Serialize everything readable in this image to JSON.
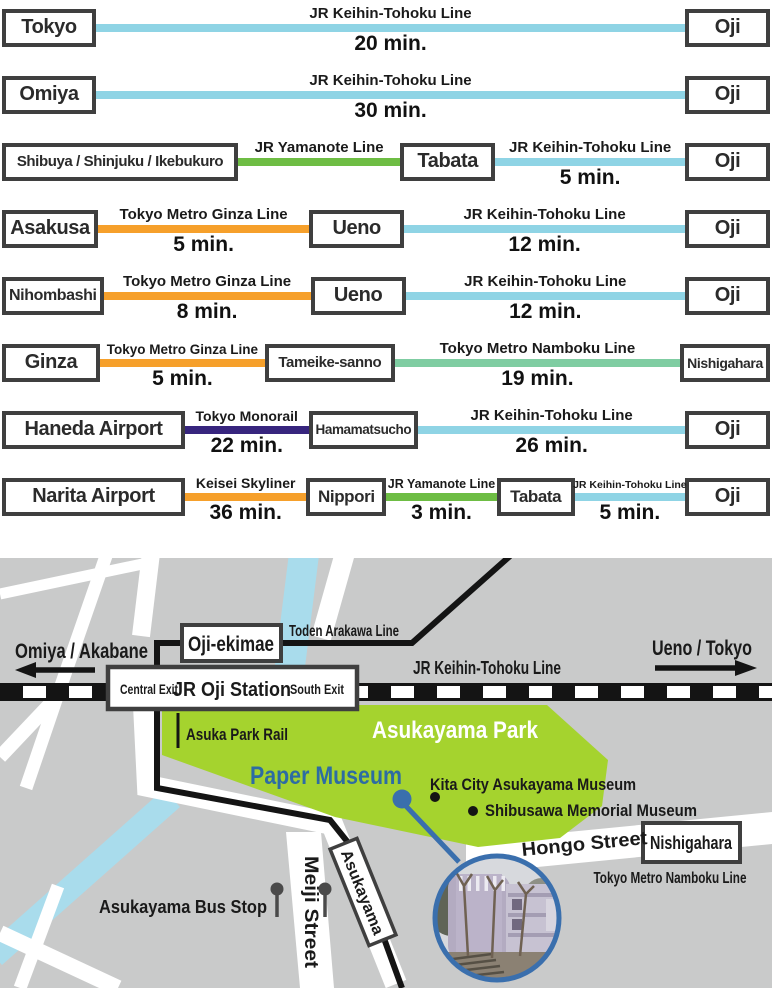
{
  "palette": {
    "keihin": "#8fd4e5",
    "yamanote": "#6ebd44",
    "ginza": "#f6a02b",
    "skyliner": "#f6a02b",
    "namboku": "#7fcda2",
    "monorail": "#37257e",
    "ink": "#141414",
    "box_border": "#3f3f3f",
    "bg_gray": "#c9caca",
    "river": "#a9dcec",
    "park": "#a5d32e",
    "museum_blue": "#2d6ca3",
    "ring_blue": "#3a6fad",
    "road_white": "#ffffff"
  },
  "routes": {
    "rows": [
      {
        "items": [
          {
            "type": "station",
            "label": "Tokyo",
            "w": 94
          },
          {
            "type": "segment",
            "line": "JR Keihin-Tohoku Line",
            "time": "20 min.",
            "color": "keihin",
            "grow": 1
          },
          {
            "type": "station",
            "label": "Oji",
            "w": 85
          }
        ]
      },
      {
        "items": [
          {
            "type": "station",
            "label": "Omiya",
            "w": 94
          },
          {
            "type": "segment",
            "line": "JR Keihin-Tohoku Line",
            "time": "30 min.",
            "color": "keihin",
            "grow": 1
          },
          {
            "type": "station",
            "label": "Oji",
            "w": 85
          }
        ]
      },
      {
        "items": [
          {
            "type": "station",
            "label": "Shibuya / Shinjuku / Ikebukuro",
            "w": 236,
            "fs": 15
          },
          {
            "type": "segment",
            "line": "JR Yamanote Line",
            "time": "",
            "color": "yamanote",
            "grow": 1
          },
          {
            "type": "station",
            "label": "Tabata",
            "w": 95
          },
          {
            "type": "segment",
            "line": "JR Keihin-Tohoku Line",
            "time": "5 min.",
            "color": "keihin",
            "grow": 1.17
          },
          {
            "type": "station",
            "label": "Oji",
            "w": 85
          }
        ]
      },
      {
        "items": [
          {
            "type": "station",
            "label": "Asakusa",
            "w": 96
          },
          {
            "type": "segment",
            "line": "Tokyo Metro Ginza Line",
            "time": "5 min.",
            "color": "ginza",
            "grow": 1
          },
          {
            "type": "station",
            "label": "Ueno",
            "w": 95
          },
          {
            "type": "segment",
            "line": "JR Keihin-Tohoku Line",
            "time": "12 min.",
            "color": "keihin",
            "grow": 1.33
          },
          {
            "type": "station",
            "label": "Oji",
            "w": 85
          }
        ]
      },
      {
        "items": [
          {
            "type": "station",
            "label": "Nihombashi",
            "w": 100,
            "fs": 16
          },
          {
            "type": "segment",
            "line": "Tokyo Metro Ginza Line",
            "time": "8 min.",
            "color": "ginza",
            "grow": 1
          },
          {
            "type": "station",
            "label": "Ueno",
            "w": 95
          },
          {
            "type": "segment",
            "line": "JR Keihin-Tohoku Line",
            "time": "12 min.",
            "color": "keihin",
            "grow": 1.35
          },
          {
            "type": "station",
            "label": "Oji",
            "w": 85
          }
        ]
      },
      {
        "items": [
          {
            "type": "station",
            "label": "Ginza",
            "w": 98
          },
          {
            "type": "segment",
            "line": "Tokyo Metro Ginza Line",
            "time": "5 min.",
            "color": "ginza",
            "grow": 1,
            "lfs": 13.5
          },
          {
            "type": "station",
            "label": "Tameike-sanno",
            "w": 130,
            "fs": 15
          },
          {
            "type": "segment",
            "line": "Tokyo Metro Namboku Line",
            "time": "19 min.",
            "color": "namboku",
            "grow": 1.73
          },
          {
            "type": "station",
            "label": "Nishigahara",
            "w": 90,
            "fs": 14
          }
        ]
      },
      {
        "items": [
          {
            "type": "station",
            "label": "Haneda Airport",
            "w": 183,
            "fs": 20
          },
          {
            "type": "segment",
            "line": "Tokyo Monorail",
            "time": "22 min.",
            "color": "monorail",
            "grow": 1,
            "lfs": 14
          },
          {
            "type": "station",
            "label": "Hamamatsucho",
            "w": 105,
            "fs": 13.5
          },
          {
            "type": "segment",
            "line": "JR Keihin-Tohoku Line",
            "time": "26 min.",
            "color": "keihin",
            "grow": 2.16
          },
          {
            "type": "station",
            "label": "Oji",
            "w": 85
          }
        ]
      },
      {
        "items": [
          {
            "type": "station",
            "label": "Narita Airport",
            "w": 183,
            "fs": 20
          },
          {
            "type": "segment",
            "line": "Keisei Skyliner",
            "time": "36 min.",
            "color": "skyliner",
            "grow": 1.1,
            "lfs": 14
          },
          {
            "type": "station",
            "label": "Nippori",
            "w": 80,
            "fs": 17
          },
          {
            "type": "segment",
            "line": "JR Yamanote Line",
            "time": "3 min.",
            "color": "yamanote",
            "grow": 1,
            "lfs": 12.5
          },
          {
            "type": "station",
            "label": "Tabata",
            "w": 78,
            "fs": 17
          },
          {
            "type": "segment",
            "line": "JR Keihin-Tohoku Line",
            "time": "5 min.",
            "color": "keihin",
            "grow": 1,
            "lfs": 10.5
          },
          {
            "type": "station",
            "label": "Oji",
            "w": 85
          }
        ]
      }
    ]
  },
  "map": {
    "rivers": [
      {
        "pts": "304,554 288,682",
        "w": 30
      },
      {
        "pts": "172,798 -6,956",
        "w": 24
      }
    ],
    "roads": [
      {
        "pts": "144,705 148,786 332,824 396,984",
        "w": 22
      },
      {
        "pts": "0,594 152,562",
        "w": 11
      },
      {
        "pts": "106,556 57,697 26,788",
        "w": 13
      },
      {
        "pts": "151,553 141,636",
        "w": 18
      },
      {
        "pts": "345,553 321,638",
        "w": 20
      },
      {
        "pts": "52,702 0,757",
        "w": 14
      },
      {
        "pts": "0,933 118,988",
        "w": 16
      },
      {
        "pts": "58,886 20,988",
        "w": 13
      }
    ],
    "road_polys": [
      {
        "points": "286,832 321,832 334,988 300,988",
        "name": "meiji-street-road"
      },
      {
        "points": "466,842 772,812 772,844 466,874",
        "name": "hongo-street-road"
      }
    ],
    "park": {
      "points": "162,705 547,705 608,760 602,806 560,838 478,847 335,817 162,755"
    },
    "tram": {
      "pts": "510,556 412,643 157,643 157,788 330,820 350,845 402,988",
      "w": 6
    },
    "railway": {
      "y": 683,
      "h": 18,
      "dash": 23
    },
    "ticks": [
      {
        "x1": 178,
        "y1": 713,
        "x2": 178,
        "y2": 748,
        "w": 3
      }
    ],
    "arrows": [
      {
        "name": "west-arrow",
        "shaft": "95,670 34,670",
        "head": "36,662 36,678 15,670"
      },
      {
        "name": "east-arrow",
        "shaft": "655,668 737,668",
        "head": "735,660 735,676 757,668"
      }
    ],
    "boxes": [
      {
        "name": "oji-ekimae-box",
        "x": 182,
        "y": 625,
        "w": 99,
        "h": 36,
        "sw": 4
      },
      {
        "name": "jr-oji-station-box",
        "x": 108,
        "y": 667,
        "w": 249,
        "h": 42,
        "sw": 4.5
      },
      {
        "name": "nishigahara-box",
        "x": 643,
        "y": 823,
        "w": 97,
        "h": 39,
        "sw": 4
      },
      {
        "name": "asukayama-tram-stop-box",
        "cx": 363,
        "cy": 892,
        "w": 104,
        "h": 29,
        "sw": 3.5,
        "rotate": 68
      }
    ],
    "labels": [
      {
        "name": "toden-arakawa-line-label",
        "text": "Toden Arakawa Line",
        "x": 344,
        "y": 636,
        "fs": 16,
        "tl": 110
      },
      {
        "name": "omiya-akabane-label",
        "text": "Omiya / Akabane",
        "x": 15,
        "y": 658,
        "fs": 21,
        "tl": 133,
        "anchor": "start"
      },
      {
        "name": "ueno-tokyo-label",
        "text": "Ueno / Tokyo",
        "x": 702,
        "y": 655,
        "fs": 21,
        "tl": 100
      },
      {
        "name": "jr-keihin-tohoku-map-label",
        "text": "JR Keihin-Tohoku Line",
        "x": 487,
        "y": 674,
        "fs": 18,
        "tl": 148
      },
      {
        "name": "asuka-park-rail-label",
        "text": "Asuka Park Rail",
        "x": 186,
        "y": 740,
        "fs": 17,
        "tl": 102,
        "anchor": "start"
      },
      {
        "name": "asukayama-park-label",
        "text": "Asukayama Park",
        "x": 455,
        "y": 738,
        "fs": 24,
        "tl": 166,
        "color": "#ffffff"
      },
      {
        "name": "paper-museum-label",
        "text": "Paper Museum",
        "x": 326,
        "y": 784,
        "fs": 25,
        "tl": 152,
        "color": "#2d6ca3"
      },
      {
        "name": "kita-city-museum-label",
        "text": "Kita City Asukayama Museum",
        "x": 430,
        "y": 790,
        "fs": 16.5,
        "tl": 206,
        "anchor": "start"
      },
      {
        "name": "shibusawa-museum-label",
        "text": "Shibusawa Memorial Museum",
        "x": 485,
        "y": 816,
        "fs": 16.5,
        "tl": 212,
        "anchor": "start"
      },
      {
        "name": "hongo-street-label",
        "text": "Hongo Street",
        "x": 585,
        "y": 850,
        "fs": 19,
        "tl": 126,
        "rotate": -5.5
      },
      {
        "name": "nishigahara-map-label",
        "text": "Nishigahara",
        "x": 691,
        "y": 849,
        "fs": 18,
        "tl": 82
      },
      {
        "name": "namboku-line-label",
        "text": "Tokyo Metro Namboku Line",
        "x": 670,
        "y": 883,
        "fs": 16,
        "tl": 153
      },
      {
        "name": "bus-stop-label",
        "text": "Asukayama Bus Stop",
        "x": 267,
        "y": 913,
        "fs": 18,
        "tl": 168,
        "anchor": "end"
      },
      {
        "name": "meiji-street-label",
        "text": "Meiji Street",
        "x": 305,
        "y": 912,
        "fs": 19,
        "tl": 112,
        "rotate": 90
      },
      {
        "name": "oji-ekimae-label",
        "text": "Oji-ekimae",
        "x": 231,
        "y": 651,
        "fs": 21,
        "tl": 86
      },
      {
        "name": "jr-oji-station-label",
        "text": "JR Oji Station",
        "x": 232,
        "y": 696,
        "fs": 20,
        "tl": 118
      },
      {
        "name": "central-exit-label",
        "text": "Central Exit",
        "x": 149,
        "y": 694,
        "fs": 13.5,
        "tl": 58
      },
      {
        "name": "south-exit-label",
        "text": "South Exit",
        "x": 317,
        "y": 694,
        "fs": 13.5,
        "tl": 54
      },
      {
        "name": "asukayama-stop-label",
        "text": "Asukayama",
        "x": 363,
        "y": 898,
        "fs": 16,
        "tl": 90,
        "rotate": 68,
        "rx": 363,
        "ry": 892
      }
    ],
    "dots": [
      {
        "name": "paper-museum-dot",
        "x": 402,
        "y": 799,
        "r": 9.5,
        "color": "#3a6fad"
      },
      {
        "name": "kita-city-museum-dot",
        "x": 435,
        "y": 797,
        "r": 5,
        "color": "#141414"
      },
      {
        "name": "shibusawa-museum-dot",
        "x": 473,
        "y": 811,
        "r": 5,
        "color": "#141414"
      }
    ],
    "pointer": {
      "x1": 404,
      "y1": 804,
      "x2": 459,
      "y2": 862
    },
    "photo": {
      "cx": 497,
      "cy": 918,
      "r": 62
    },
    "busstops": [
      {
        "x": 277,
        "y": 889
      },
      {
        "x": 325,
        "y": 889
      }
    ]
  }
}
